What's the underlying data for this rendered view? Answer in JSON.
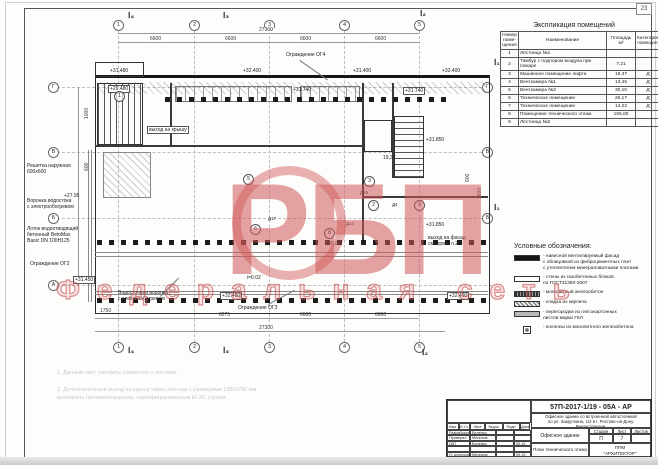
{
  "sheet": {
    "corner_number": "23",
    "watermark": {
      "main": "РБП",
      "sub": "Федеральная сеть",
      "color": "#cc5555"
    }
  },
  "explication": {
    "title": "Экспликация помещений",
    "headers": {
      "num": "Номер поме-щения",
      "name": "Наименование",
      "area": "Площадь м²",
      "cat": "Категория помещен."
    },
    "rows": [
      {
        "num": "1",
        "name": "Лестница №1",
        "area": "",
        "cat": ""
      },
      {
        "num": "2",
        "name": "Тамбур с подпором воздуха при пожаре",
        "area": "7,21",
        "cat": ""
      },
      {
        "num": "3",
        "name": "Машинное помещение лифта",
        "area": "19,37",
        "cat": "Д"
      },
      {
        "num": "4",
        "name": "Венткамера №1",
        "area": "13,45",
        "cat": "Д"
      },
      {
        "num": "5",
        "name": "Венткамера №2",
        "area": "30,10",
        "cat": "Д"
      },
      {
        "num": "6",
        "name": "Техническое помещение",
        "area": "26,17",
        "cat": "Д"
      },
      {
        "num": "7",
        "name": "Техническое помещение",
        "area": "14,22",
        "cat": "Д"
      },
      {
        "num": "8",
        "name": "Помещение технического этажа",
        "area": "155,00",
        "cat": ""
      },
      {
        "num": "9",
        "name": "Лестница №2",
        "area": "",
        "cat": ""
      }
    ]
  },
  "legend": {
    "title": "Условные обозначения:",
    "items": [
      {
        "symbol": "solid",
        "label": "- навесной вентилируемый фасад\n  с облицовкой из фиброцементных плит\n  с утеплителем минераловатными плитами"
      },
      {
        "symbol": "outline",
        "label": "- стены из газобетонных блоков\n  по ГОСТ31360-2007"
      },
      {
        "symbol": "dark-hatch",
        "label": "- монолитный железобетон"
      },
      {
        "symbol": "brick",
        "label": "- кладка из кирпича"
      },
      {
        "symbol": "gray",
        "label": "- перегородки из гипсокартонных\n  листов марки ГКЛ"
      },
      {
        "symbol": "column",
        "label": "- колонны из монолитного железобетона"
      }
    ]
  },
  "notes": {
    "line1": "1.  Данный лист смотреть совместно с листами",
    "line2": "2.  Дополнительный выход на крышу через люк-лаз с размерами 1280х780 мм\n      выполнить противопожарным, сертифицированным EI-30, глухим."
  },
  "titleblock": {
    "doc_number": "57П-2017-1/19 - 05А - АР",
    "project": "Офисное здание со встроенной автостоянкой\nпо ул. Закруткина, 1/2 в г. Ростове-на-Дону.\nРеконструкция.",
    "object_name": "Офисное здание",
    "sheet_name": "План технического этажа",
    "company": "ППМ\n\"АРХИТЕКТОР\"",
    "stage_label": "Стадия",
    "sheet_label": "Лист",
    "sheets_label": "Листов",
    "stage": "П",
    "sheet_no": "7",
    "sheets_total": "",
    "header_cells": [
      "Изм.",
      "К.Уч.",
      "Лист",
      "№док.",
      "Подп.",
      "Дата"
    ],
    "sign_rows": [
      {
        "role": "Разработал",
        "name": "Беленко",
        "date": ""
      },
      {
        "role": "Проверил",
        "name": "Мелихов",
        "date": ""
      },
      {
        "role": "ГАП",
        "name": "Беленко",
        "date": "09.19"
      },
      {
        "role": "",
        "name": "",
        "date": ""
      },
      {
        "role": "Н. контроль",
        "name": "Мелихов",
        "date": "09.19"
      }
    ]
  },
  "plan": {
    "axes_top": [
      "1",
      "2",
      "3",
      "4",
      "5"
    ],
    "axes_bottom": [
      "1",
      "2",
      "3",
      "4",
      "5"
    ],
    "axes_left": [
      "Г",
      "В",
      "Б",
      "А"
    ],
    "axes_right": [
      "Г",
      "В",
      "Б"
    ],
    "section_marks": {
      "t1": "Ⅰ₄",
      "t2": "Ⅰ₃",
      "t3": "Ⅰ₂",
      "b1": "Ⅰ₄",
      "b2": "Ⅰ₃",
      "b3": "Ⅰ₂",
      "r1": "Ⅰ₁",
      "r2": "Ⅰ₁"
    },
    "dims": {
      "top_total": "27300",
      "top_bays": [
        "6600",
        "6600",
        "6600",
        "6600"
      ],
      "bottom_bays": [
        "1750",
        "6275",
        "6600",
        "6600"
      ],
      "bottom_total": "27300",
      "left_side": [
        "1000",
        "600"
      ],
      "right_side": [
        "600",
        "1600"
      ]
    },
    "elevations": {
      "t1": "+31.480",
      "t2": "+32.400",
      "t3": "+31.740",
      "t4": "+31.400",
      "t5": "+32.400",
      "box_tl": "+29.480",
      "box_tr": "+31.740",
      "right_upper": "+31.850",
      "right_lower": "+31.850",
      "left_mid": "+27.95",
      "box_p1": "+31.450",
      "box_p2": "+32.400",
      "box_p3": "+32.400"
    },
    "annotations": {
      "og4": "Ограждение ОГ4",
      "grille": "Решетка наружная\n600х600",
      "drain_funnel": "Воронка водостока\nс электрообогревом",
      "tray": "Лоток водоотводящий\nбетонный BetoMax\nBasic DN 100Н125",
      "og2": "Ограждение ОГ2",
      "storm_funnel": "Водосточная воронка\nс электрообогревом",
      "og3": "Ограждение ОГЗ",
      "roof_exit": "выход на крышу",
      "facade_exit": "выход на фасад\nсм. прим. п.2",
      "slope": "i=0.02",
      "area_room8": "155,00",
      "area_room3": "19,37"
    },
    "room_tags": [
      "1",
      "5",
      "6",
      "3",
      "2",
      "8",
      "9"
    ],
    "door_tags": [
      "Д16",
      "Д4",
      "Д14",
      "Д17"
    ]
  }
}
